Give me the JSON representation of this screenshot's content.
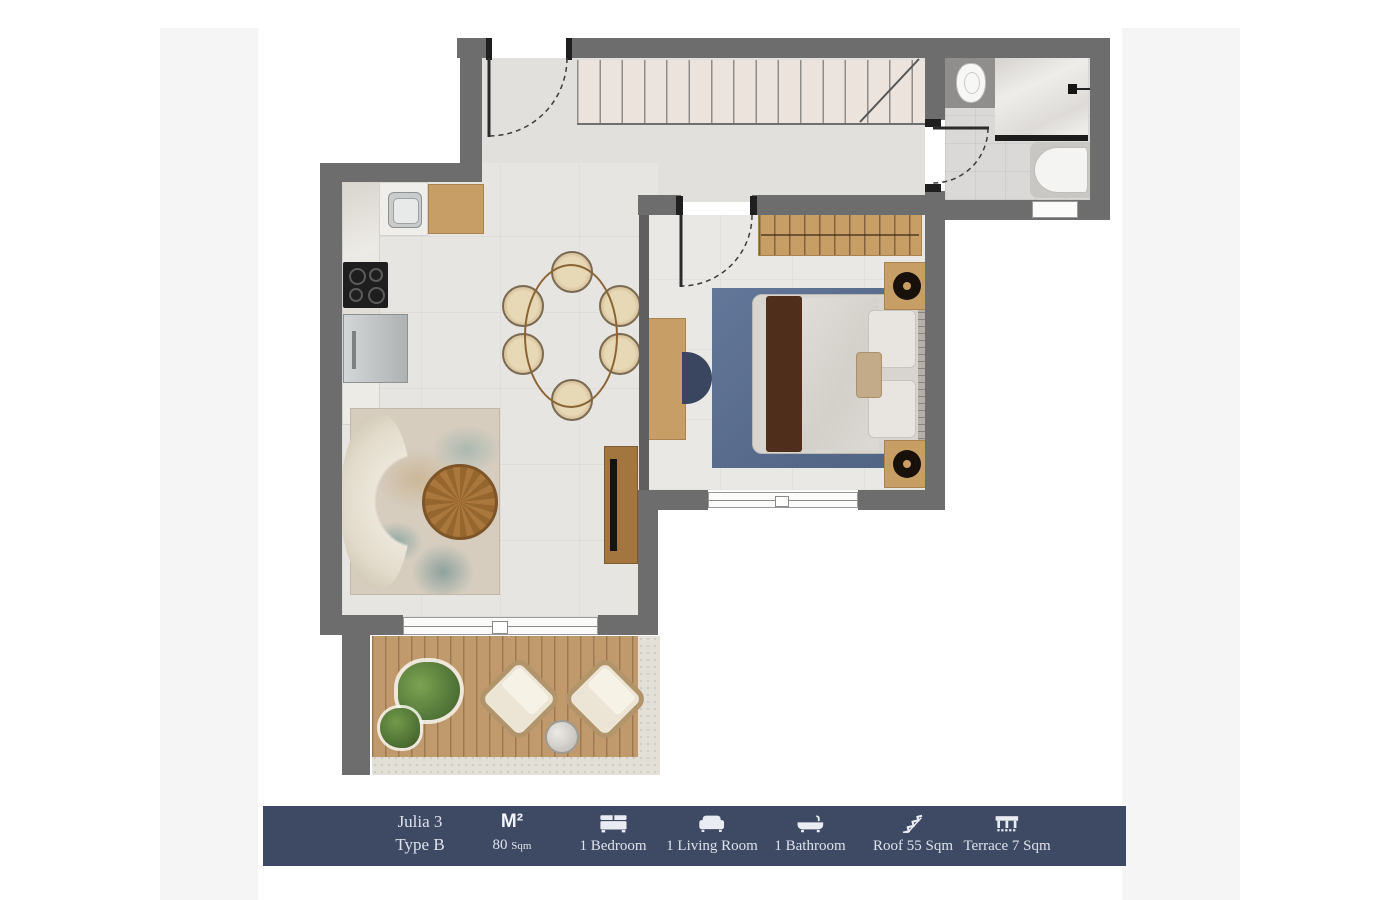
{
  "legend": {
    "bar_color": "#3e4a63",
    "text_color": "#dde2ec",
    "unit_name": "Julia 3",
    "unit_type": "Type B",
    "area_symbol": "M²",
    "area_value": "80",
    "area_unit": "Sqm",
    "features": [
      {
        "icon": "bed-icon",
        "label": "1 Bedroom"
      },
      {
        "icon": "sofa-icon",
        "label": "1 Living Room"
      },
      {
        "icon": "bathtub-icon",
        "label": "1 Bathroom"
      },
      {
        "icon": "roof-stairs-icon",
        "label": "Roof 55 Sqm"
      },
      {
        "icon": "terrace-icon",
        "label": "Terrace 7 Sqm"
      }
    ]
  },
  "plan": {
    "colors": {
      "wall": "#6d6d6d",
      "floor_marble": "#e7e5e2",
      "stair_fill": "#ebe3dc",
      "wood": "#c79f66",
      "deck": "#c09a6c",
      "bedroom_rug": "#5d7191",
      "bed_throw": "#4f2e1b",
      "plant": "#55793a",
      "navy_chair": "#3a4660"
    }
  }
}
